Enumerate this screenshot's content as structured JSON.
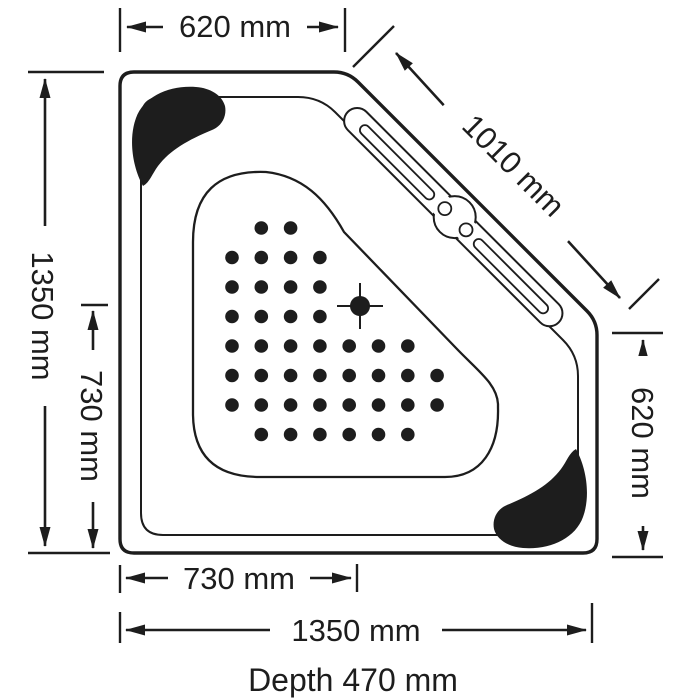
{
  "drawing": {
    "dims": {
      "top_width": "620 mm",
      "diagonal_width": "1010 mm",
      "left_height": "1350 mm",
      "left_drain_offset": "730 mm",
      "right_height": "620 mm",
      "bottom_drain_offset": "730 mm",
      "bottom_width": "1350 mm",
      "depth_note": "Depth 470 mm"
    },
    "colors": {
      "ink": "#1d1d1d",
      "background": "#ffffff"
    },
    "dots": {
      "origin_x": 232,
      "origin_y": 228,
      "spacing_x": 29.3,
      "spacing_y": 29.5,
      "radius": 6.8,
      "rows": [
        [
          1,
          2
        ],
        [
          0,
          1,
          2,
          3
        ],
        [
          0,
          1,
          2,
          3
        ],
        [
          0,
          1,
          2,
          3
        ],
        [
          0,
          1,
          2,
          3,
          4,
          5,
          6
        ],
        [
          0,
          1,
          2,
          3,
          4,
          5,
          6,
          7
        ],
        [
          0,
          1,
          2,
          3,
          4,
          5,
          6,
          7
        ],
        [
          1,
          2,
          3,
          4,
          5,
          6
        ]
      ]
    }
  }
}
